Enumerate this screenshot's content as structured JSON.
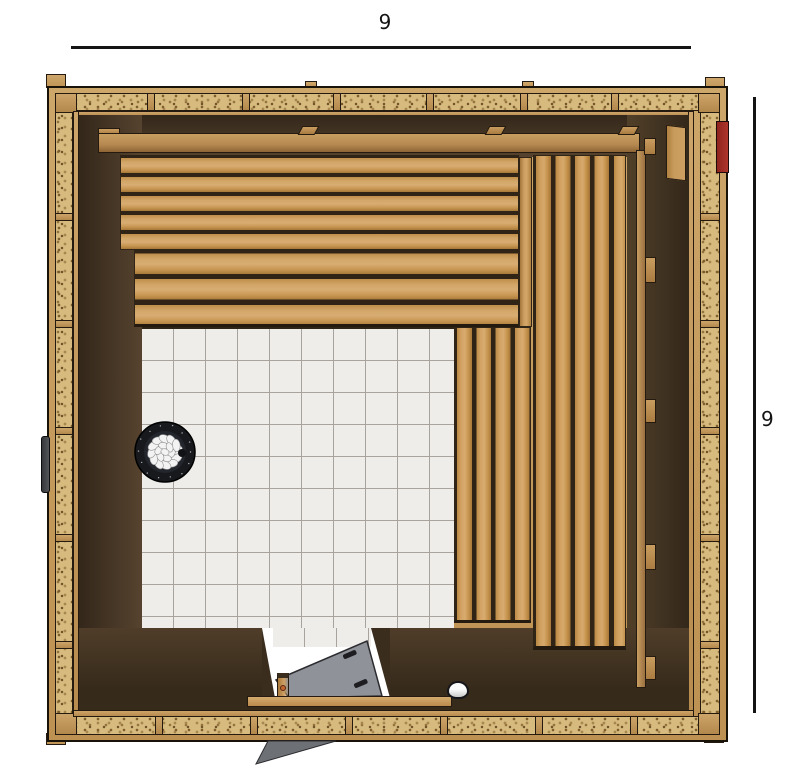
{
  "title": "Sauna kit floor plan (top view)",
  "dimensions": {
    "top_label": "9",
    "right_label": "9"
  },
  "colors": {
    "line": "#141414",
    "osb": "#d6ba7e",
    "frame_wood": "#c8a064",
    "wall_dark": "#3a2d1e",
    "bench_wood": "#cd9f60",
    "tile": "#efedea",
    "grout": "#a8a39d",
    "door_glass": "#8f9298",
    "door_shadow": "#6d7175",
    "red": "#ae352c",
    "heater_ring": "#17191d",
    "stone": "#f3f3f3",
    "drain_cap": "#f2f2f2",
    "handle": "#46484b"
  }
}
